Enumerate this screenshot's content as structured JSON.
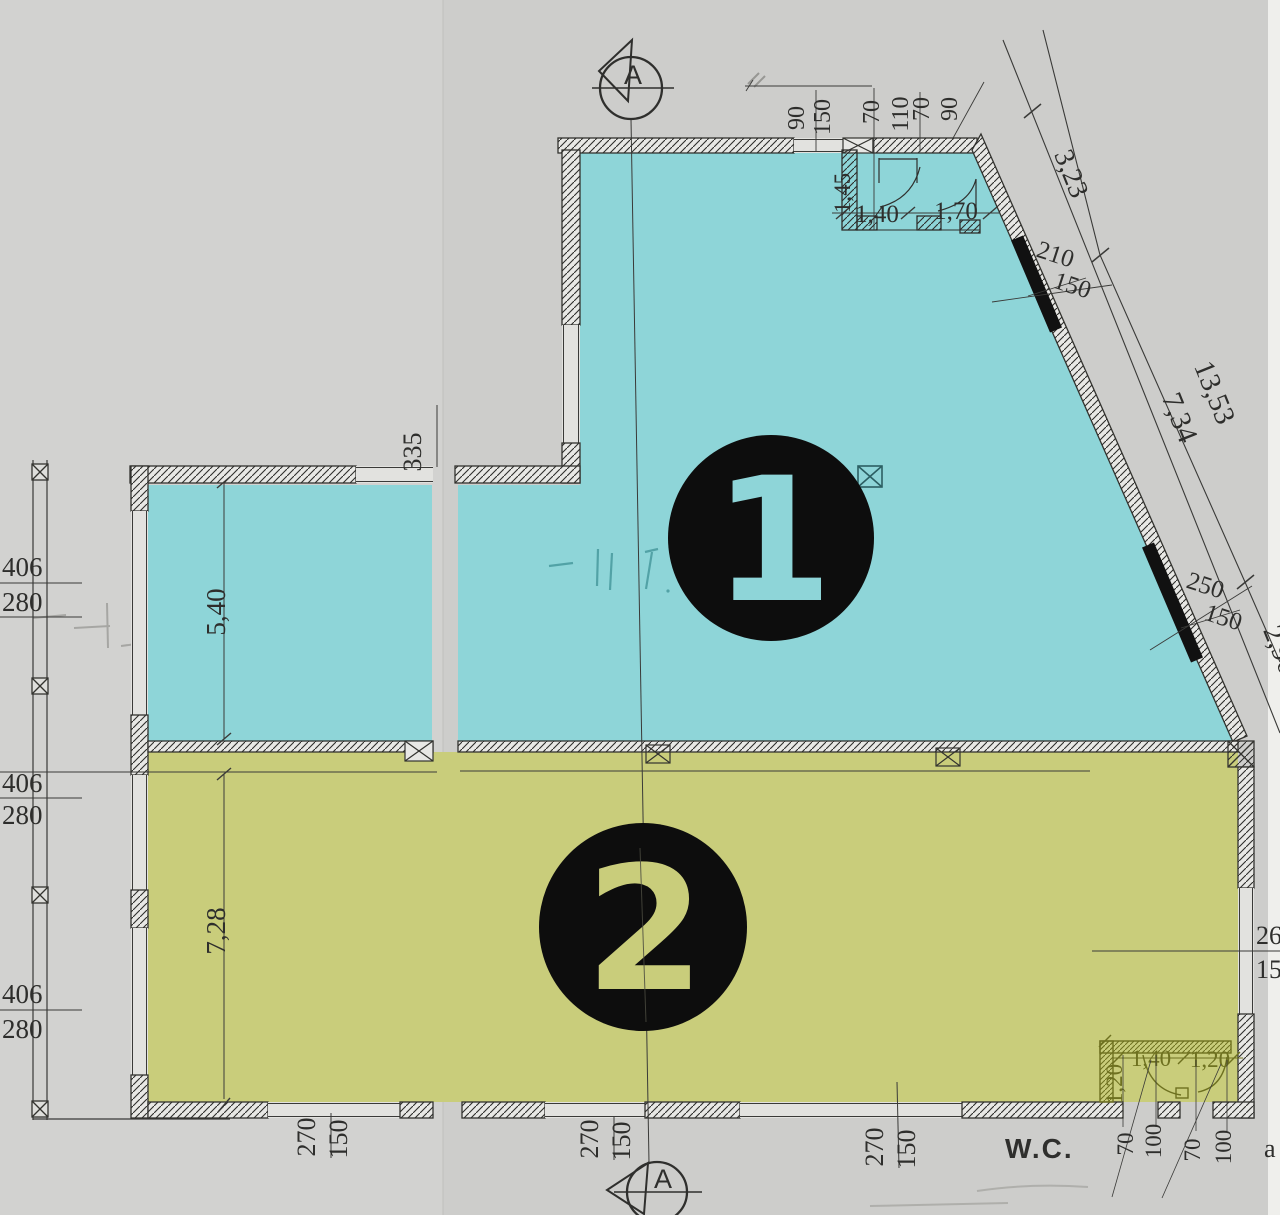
{
  "title": "Floor plan scan with two highlighted units",
  "colors": {
    "paper": "#cdcdcb",
    "paper_left": "#d2d2d0",
    "zone1": "#8ed5d8",
    "zone2": "#c9cd7b",
    "marker_black": "#0d0d0d",
    "ink": "#2e2e2c",
    "olive": "#6e7120"
  },
  "zones": [
    {
      "id": "zone-1",
      "digit": "1",
      "fill": "#8ed5d8"
    },
    {
      "id": "zone-2",
      "digit": "2",
      "fill": "#c9cd7b"
    }
  ],
  "section_markers": {
    "top": "A",
    "bottom": "A"
  },
  "labels": {
    "top_d1": "90",
    "top_d2": "150",
    "top_d3": "70",
    "top_d4": "110",
    "top_d5": "70",
    "top_d6": "90",
    "bath_depth": "1,45",
    "bath_w1": "1,40",
    "bath_w2": "1,70",
    "diag_seg_upper": "3,23",
    "diag_total": "13,53",
    "diag_seg_mid": "7,34",
    "diag_seg_lower": "2,96",
    "slantwin1_a": "210",
    "slantwin1_b": "150",
    "slantwin2_a": "250",
    "slantwin2_b": "150",
    "left_p1_a": "406",
    "left_p1_b": "280",
    "left_p2_a": "406",
    "left_p2_b": "280",
    "left_p3_a": "406",
    "left_p3_b": "280",
    "step_dim": "335",
    "zone1_depth": "5,40",
    "zone2_depth": "7,28",
    "botwin1_a": "270",
    "botwin1_b": "150",
    "botwin2_a": "270",
    "botwin2_b": "150",
    "botwin3_a": "270",
    "botwin3_b": "150",
    "rightwin_a": "260",
    "rightwin_b": "150",
    "wc_title": "W.C.",
    "wc_depth": "1,20",
    "wc_w1": "1,40",
    "wc_w2": "1,20",
    "wc_o1": "70",
    "wc_o2": "100",
    "wc_o3": "70",
    "wc_o4": "100",
    "edge_fragment": "a"
  }
}
